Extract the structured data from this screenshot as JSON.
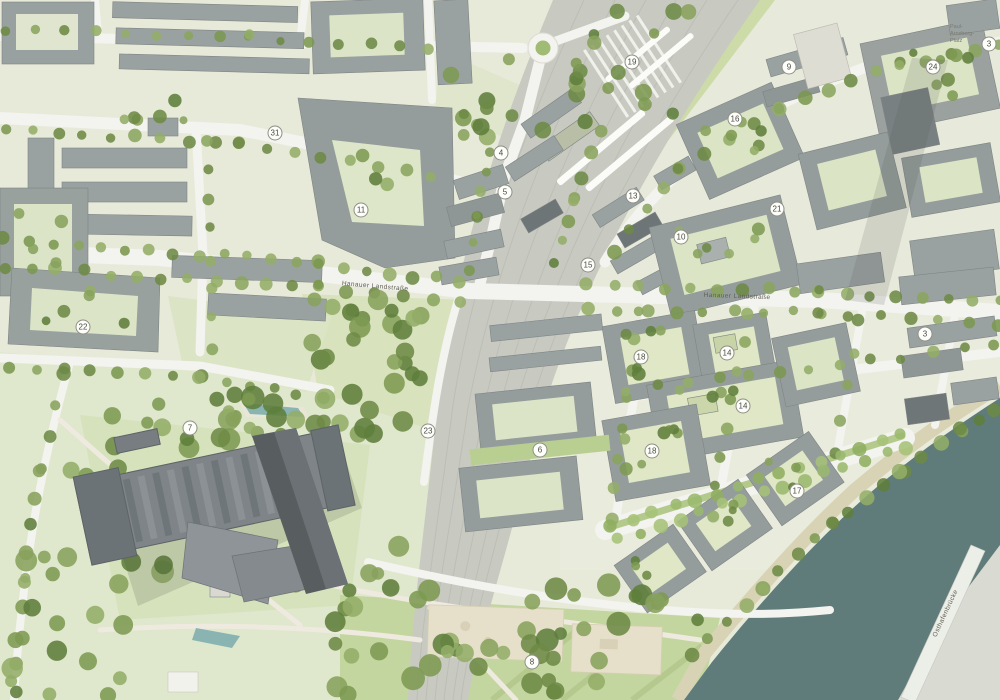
{
  "map": {
    "type": "urban-masterplan-site-plan",
    "street_labels": [
      {
        "text": "Hanauer Landstraße",
        "x": 375,
        "y": 288,
        "rot": 5,
        "size": 6.5
      },
      {
        "text": "Hanauer Landstraße",
        "x": 737,
        "y": 298,
        "rot": 2,
        "size": 6.5
      },
      {
        "text": "Osthafenbrücke",
        "x": 947,
        "y": 614,
        "rot": -65,
        "size": 6.5
      }
    ],
    "place_labels": [
      {
        "lines": [
          "Paul-",
          "Arnsberg-",
          "Platz"
        ],
        "x": 950,
        "y": 28,
        "size": 5.5
      }
    ],
    "markers": [
      {
        "label": "19",
        "x": 632,
        "y": 62
      },
      {
        "label": "9",
        "x": 789,
        "y": 67
      },
      {
        "label": "24",
        "x": 933,
        "y": 67
      },
      {
        "label": "3",
        "x": 989,
        "y": 44
      },
      {
        "label": "16",
        "x": 735,
        "y": 119
      },
      {
        "label": "31",
        "x": 275,
        "y": 133
      },
      {
        "label": "4",
        "x": 501,
        "y": 153
      },
      {
        "label": "5",
        "x": 505,
        "y": 192
      },
      {
        "label": "13",
        "x": 633,
        "y": 196
      },
      {
        "label": "11",
        "x": 361,
        "y": 210
      },
      {
        "label": "21",
        "x": 777,
        "y": 209
      },
      {
        "label": "10",
        "x": 681,
        "y": 237
      },
      {
        "label": "15",
        "x": 588,
        "y": 265
      },
      {
        "label": "22",
        "x": 83,
        "y": 327
      },
      {
        "label": "3",
        "x": 925,
        "y": 334
      },
      {
        "label": "18",
        "x": 641,
        "y": 357
      },
      {
        "label": "14",
        "x": 727,
        "y": 353
      },
      {
        "label": "14",
        "x": 743,
        "y": 406
      },
      {
        "label": "23",
        "x": 428,
        "y": 431
      },
      {
        "label": "7",
        "x": 190,
        "y": 428
      },
      {
        "label": "6",
        "x": 540,
        "y": 450
      },
      {
        "label": "18",
        "x": 652,
        "y": 451
      },
      {
        "label": "17",
        "x": 797,
        "y": 491
      },
      {
        "label": "8",
        "x": 532,
        "y": 662
      }
    ],
    "colors": {
      "water": "#5f7c7a",
      "riverbank": "#d9d3b6",
      "rail_corridor": "#c8cac2",
      "road": "#f3f3ef",
      "building_mid": "#99a1a0",
      "building_dark": "#6e7576",
      "ecb_dark": "#585d60",
      "park_green": "#dfe7cd",
      "lawn_bright": "#c3d6a0",
      "court_green": "#dce4c8",
      "court_mint": "#dfe7c6",
      "marker_fill": "#fdfdfa",
      "marker_ring": "#8f8f86"
    }
  }
}
